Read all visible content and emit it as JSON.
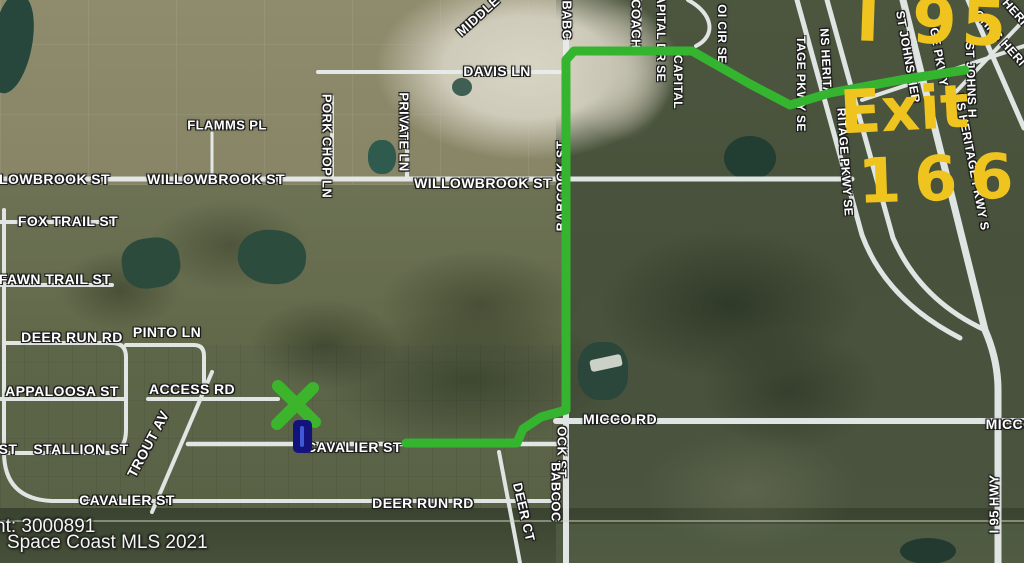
{
  "map": {
    "description": "aerial satellite map with street overlay",
    "attribution": {
      "line1": "nt: 3000891",
      "line2": "Space Coast MLS 2021"
    }
  },
  "annotations": {
    "color": "#f0c41e",
    "highway_label": "I 95",
    "exit_label": "Exit",
    "exit_number": "166",
    "route": {
      "color": "#35b430",
      "width": 9,
      "points": "965,70 900,80 830,93 790,105 750,84 692,51 574,51 566,60 566,410 541,417 523,429 517,443 406,443"
    },
    "x_mark": {
      "color": "#3cb52c",
      "cx": 296,
      "cy": 404
    },
    "property_marker": {
      "fill": "#14137b",
      "stripe": "#4059d6"
    }
  },
  "road_labels": [
    {
      "text": "MIDDLE",
      "x": 478,
      "y": 16,
      "rot": -42,
      "size": 13
    },
    {
      "text": "BABC",
      "x": 567,
      "y": 20,
      "rot": 90,
      "size": 13
    },
    {
      "text": "DAVIS LN",
      "x": 497,
      "y": 71,
      "rot": 0,
      "size": 14
    },
    {
      "text": "COACH",
      "x": 636,
      "y": 24,
      "rot": 90,
      "size": 13
    },
    {
      "text": "CAPITAL DR SE",
      "x": 661,
      "y": 34,
      "rot": 90,
      "size": 12
    },
    {
      "text": "CAPITAL",
      "x": 678,
      "y": 82,
      "rot": 90,
      "size": 12
    },
    {
      "text": "OI CIR SE",
      "x": 722,
      "y": 34,
      "rot": 90,
      "size": 12
    },
    {
      "text": "TAGE PKWY SE",
      "x": 801,
      "y": 84,
      "rot": 90,
      "size": 12
    },
    {
      "text": "NS HERITA",
      "x": 826,
      "y": 62,
      "rot": 87,
      "size": 12
    },
    {
      "text": "RITAGE PKWY SE",
      "x": 845,
      "y": 162,
      "rot": 86,
      "size": 12
    },
    {
      "text": "GE PKWY",
      "x": 939,
      "y": 57,
      "rot": 80,
      "size": 12
    },
    {
      "text": "ST JOHNS H",
      "x": 971,
      "y": 80,
      "rot": 88,
      "size": 12
    },
    {
      "text": "ST JOHNS HER",
      "x": 908,
      "y": 57,
      "rot": 80,
      "size": 12
    },
    {
      "text": "NS HERITAGE PKWY S",
      "x": 972,
      "y": 162,
      "rot": 79,
      "size": 12
    },
    {
      "text": "OHNS HERI",
      "x": 1000,
      "y": 38,
      "rot": 48,
      "size": 12
    },
    {
      "text": "HERI",
      "x": 1015,
      "y": 12,
      "rot": 48,
      "size": 12
    },
    {
      "text": "LLOWBROOK ST",
      "x": 50,
      "y": 179,
      "rot": 0,
      "size": 14
    },
    {
      "text": "WILLOWBROOK ST",
      "x": 216,
      "y": 179,
      "rot": 0,
      "size": 14
    },
    {
      "text": "WILLOWBROOK ST",
      "x": 483,
      "y": 183,
      "rot": 0,
      "size": 14
    },
    {
      "text": "FLAMMS PL",
      "x": 227,
      "y": 125,
      "rot": 0,
      "size": 13
    },
    {
      "text": "PORK CHOP LN",
      "x": 327,
      "y": 146,
      "rot": 90,
      "size": 13
    },
    {
      "text": "PRIVATE LN",
      "x": 404,
      "y": 132,
      "rot": 90,
      "size": 13
    },
    {
      "text": "BABCOCK ST",
      "x": 561,
      "y": 186,
      "rot": -90,
      "size": 13
    },
    {
      "text": "FOX TRAIL ST",
      "x": 68,
      "y": 221,
      "rot": 0,
      "size": 14
    },
    {
      "text": "FAWN TRAIL ST",
      "x": 55,
      "y": 279,
      "rot": 0,
      "size": 14
    },
    {
      "text": "DEER RUN RD",
      "x": 72,
      "y": 337,
      "rot": 0,
      "size": 14
    },
    {
      "text": "PINTO LN",
      "x": 167,
      "y": 332,
      "rot": 0,
      "size": 14
    },
    {
      "text": "APPALOOSA ST",
      "x": 62,
      "y": 391,
      "rot": 0,
      "size": 14
    },
    {
      "text": "ACCESS RD",
      "x": 192,
      "y": 389,
      "rot": 0,
      "size": 14
    },
    {
      "text": "ST",
      "x": 8,
      "y": 449,
      "rot": 0,
      "size": 14
    },
    {
      "text": "STALLION ST",
      "x": 81,
      "y": 449,
      "rot": 0,
      "size": 14
    },
    {
      "text": "TROUT AV",
      "x": 148,
      "y": 444,
      "rot": -62,
      "size": 14
    },
    {
      "text": "CAVALIER ST",
      "x": 354,
      "y": 447,
      "rot": 0,
      "size": 14
    },
    {
      "text": "MICCO RD",
      "x": 620,
      "y": 419,
      "rot": 0,
      "size": 14
    },
    {
      "text": "MICCO",
      "x": 1010,
      "y": 424,
      "rot": 0,
      "size": 14
    },
    {
      "text": "CAVALIER ST",
      "x": 127,
      "y": 500,
      "rot": 0,
      "size": 14
    },
    {
      "text": "DEER RUN RD",
      "x": 423,
      "y": 503,
      "rot": 0,
      "size": 14
    },
    {
      "text": "DEER CT",
      "x": 524,
      "y": 512,
      "rot": 77,
      "size": 13
    },
    {
      "text": "OCK ST",
      "x": 562,
      "y": 452,
      "rot": 90,
      "size": 13
    },
    {
      "text": "BABCOC",
      "x": 556,
      "y": 492,
      "rot": 90,
      "size": 13
    },
    {
      "text": "I 95 HWY",
      "x": 994,
      "y": 504,
      "rot": -90,
      "size": 13
    }
  ]
}
